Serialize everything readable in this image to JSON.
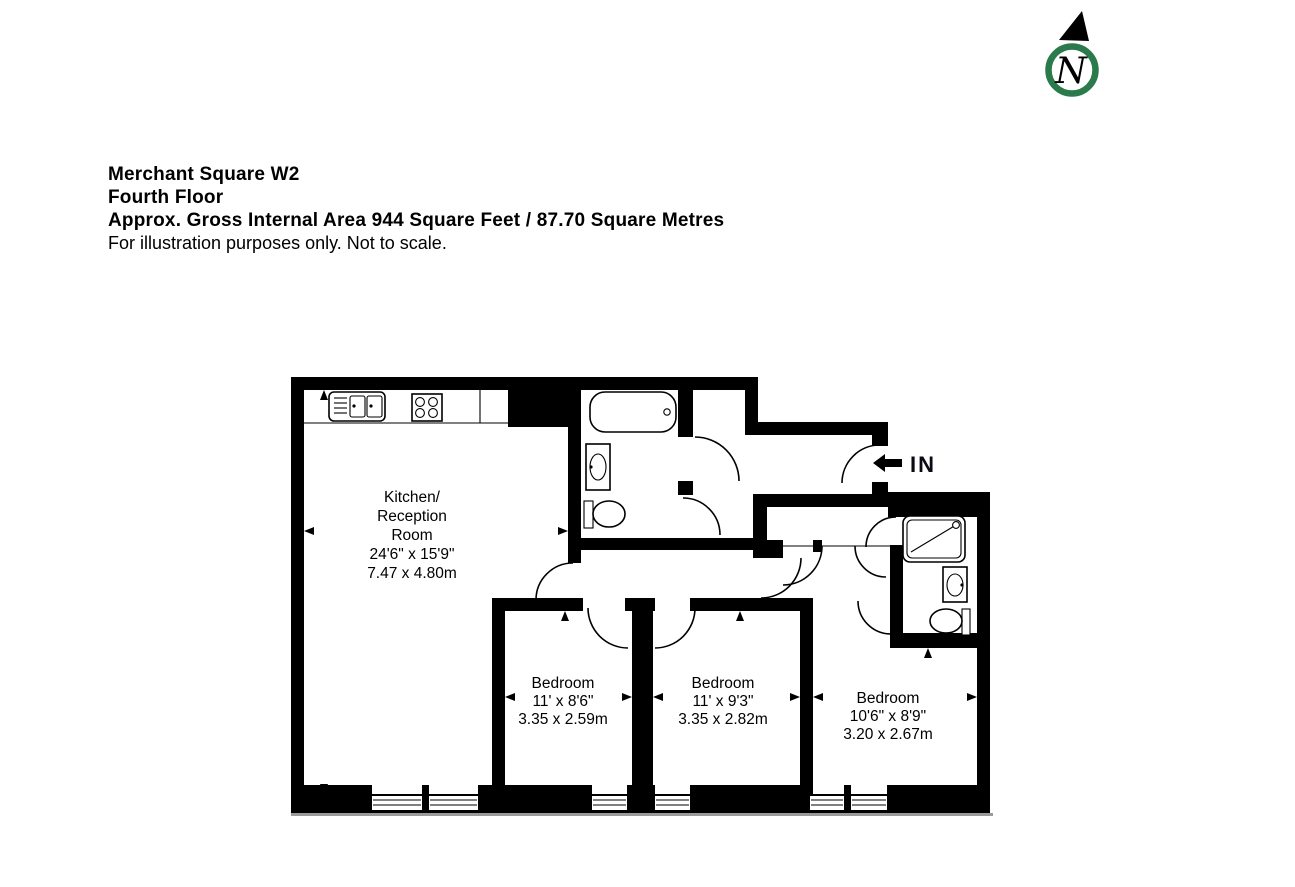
{
  "title_block": {
    "line1": "Merchant Square W2",
    "line2": "Fourth Floor",
    "line3": "Approx. Gross Internal Area 944 Square Feet / 87.70 Square Metres",
    "line4": "For illustration purposes only. Not to scale."
  },
  "north_indicator": {
    "letter": "N",
    "ring_color": "#2a7a4c"
  },
  "entrance": {
    "label": "IN"
  },
  "rooms": {
    "kitchen": {
      "name_lines": [
        "Kitchen/",
        "Reception",
        "Room"
      ],
      "dims_imperial": "24'6\" x 15'9\"",
      "dims_metric": "7.47 x 4.80m"
    },
    "bedroom1": {
      "name": "Bedroom",
      "dims_imperial": "11' x 8'6\"",
      "dims_metric": "3.35 x 2.59m"
    },
    "bedroom2": {
      "name": "Bedroom",
      "dims_imperial": "11' x 9'3\"",
      "dims_metric": "3.35 x 2.82m"
    },
    "bedroom3": {
      "name": "Bedroom",
      "dims_imperial": "10'6\" x 8'9\"",
      "dims_metric": "3.20 x 2.67m"
    }
  }
}
